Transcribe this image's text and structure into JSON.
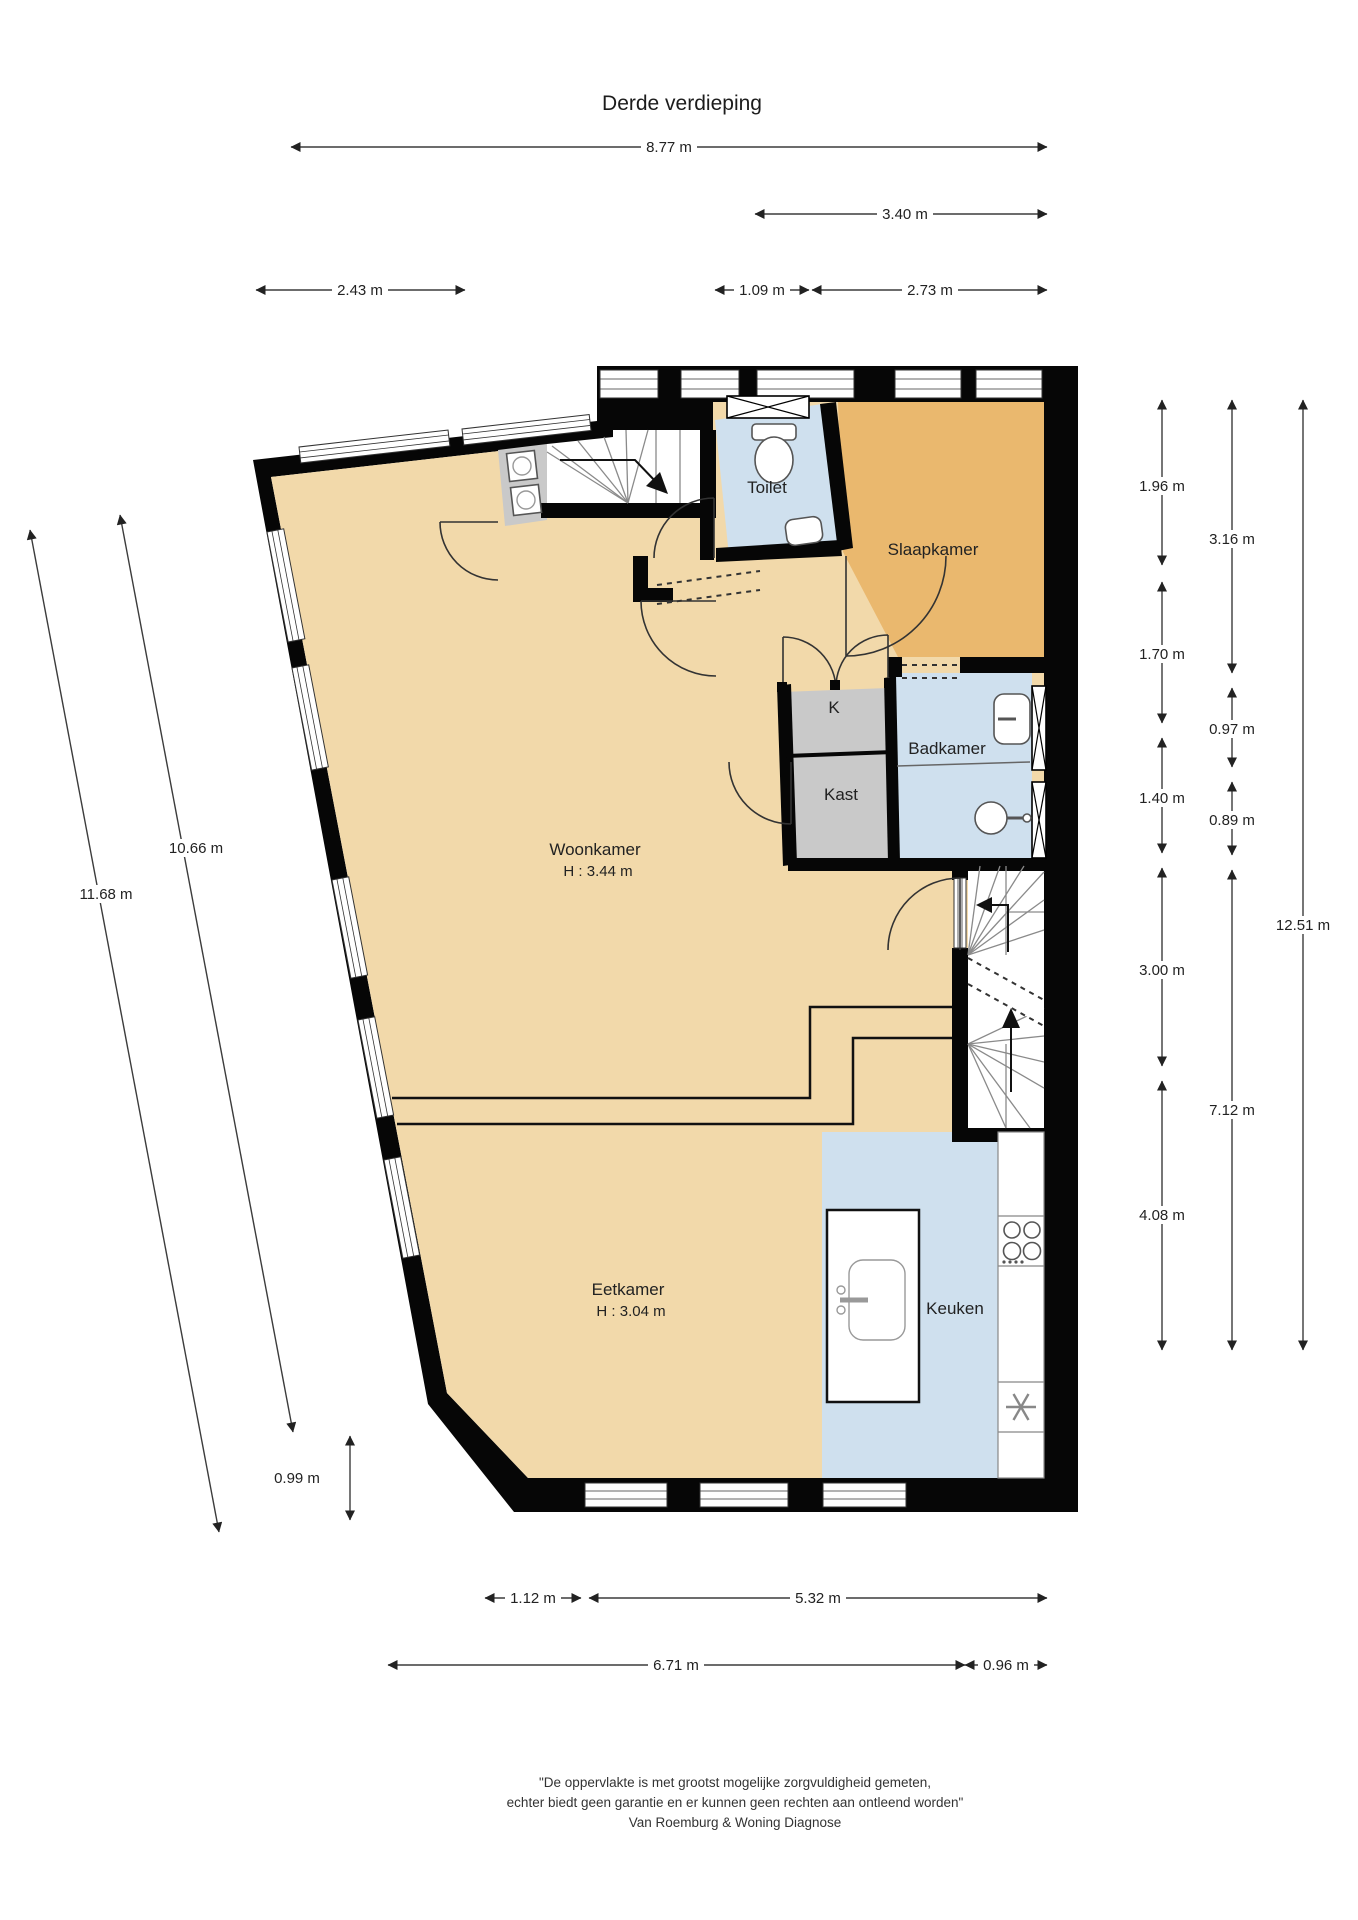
{
  "title": "Derde verdieping",
  "rooms": {
    "toilet": "Toilet",
    "slaapkamer": "Slaapkamer",
    "k": "K",
    "badkamer": "Badkamer",
    "kast": "Kast",
    "woonkamer": "Woonkamer",
    "woonkamer_h": "H : 3.44 m",
    "eetkamer": "Eetkamer",
    "eetkamer_h": "H : 3.04 m",
    "keuken": "Keuken"
  },
  "dimensions": {
    "top": [
      "8.77 m",
      "3.40 m",
      "2.43 m",
      "1.09 m",
      "2.73 m"
    ],
    "left": [
      "10.66 m",
      "11.68 m",
      "0.99 m"
    ],
    "right_col1": [
      "1.96 m",
      "1.70 m",
      "1.40 m",
      "3.00 m",
      "4.08 m"
    ],
    "right_col2": [
      "3.16 m",
      "0.97 m",
      "0.89 m",
      "7.12 m"
    ],
    "right_col3": [
      "12.51 m"
    ],
    "bottom": [
      "1.12 m",
      "5.32 m",
      "6.71 m",
      "0.96 m"
    ]
  },
  "footer": {
    "line1": "\"De oppervlakte is met grootst mogelijke zorgvuldigheid gemeten,",
    "line2": "echter biedt geen garantie en er kunnen geen rechten aan ontleend worden\"",
    "line3": "Van Roemburg & Woning Diagnose"
  },
  "colors": {
    "floor_tan": "#f2d9aa",
    "bedroom_orange": "#eab86e",
    "wet_room_blue": "#cfe0ee",
    "closet_gray": "#c9c9c9",
    "wall_black": "#060606"
  }
}
